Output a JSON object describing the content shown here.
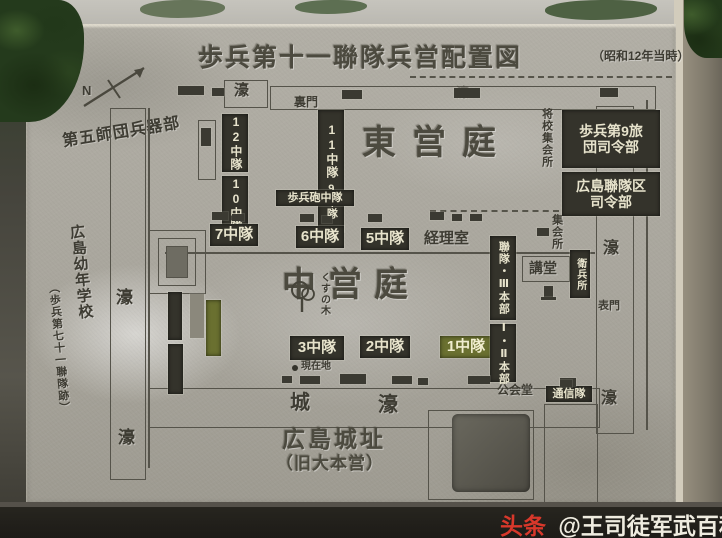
{
  "watermark": {
    "brand": "头条",
    "handle": "@王司徒军武百科"
  },
  "map": {
    "title": "歩兵第十一聯隊兵営配置図",
    "title_note": "（昭和12年当時）",
    "compass": "N",
    "grounds": {
      "east": "東営庭",
      "middle": "中営庭"
    },
    "terrain": {
      "moat": "濠",
      "castle": "城"
    },
    "site": {
      "name": "広島城址",
      "note": "（旧大本営）"
    },
    "annotations": {
      "ordnance": "第五師団兵器部",
      "school": "広島幼年学校",
      "school_note": "（歩兵第七十一聯隊跡）",
      "current_location": "現在地",
      "camphor_tree": "くすの木"
    },
    "gates": {
      "back": "裏門",
      "front": "表門"
    },
    "buildings": {
      "brigade_hq_l1": "歩兵第9旅",
      "brigade_hq_l2": "団司令部",
      "district_hq_l1": "広島聯隊区",
      "district_hq_l2": "司令部",
      "officers_hall": "将校集会所",
      "assembly_hall": "集会所",
      "regiment_hq": "聯隊・Ⅲ本部",
      "battalion_hq": "Ⅰ・Ⅱ本部",
      "lecture_hall": "講堂",
      "guard_post": "衛兵所",
      "public_hall": "公会堂",
      "signal_unit": "通信隊",
      "accounting": "経理室",
      "infantry_gun": "歩兵砲中隊"
    },
    "companies": {
      "c1": "1中隊",
      "c2": "2中隊",
      "c3": "3中隊",
      "c5": "5中隊",
      "c6": "6中隊",
      "c7": "7中隊",
      "c9": "9中隊",
      "c10": "10中隊",
      "c11": "11中隊",
      "c12": "12中隊"
    }
  }
}
